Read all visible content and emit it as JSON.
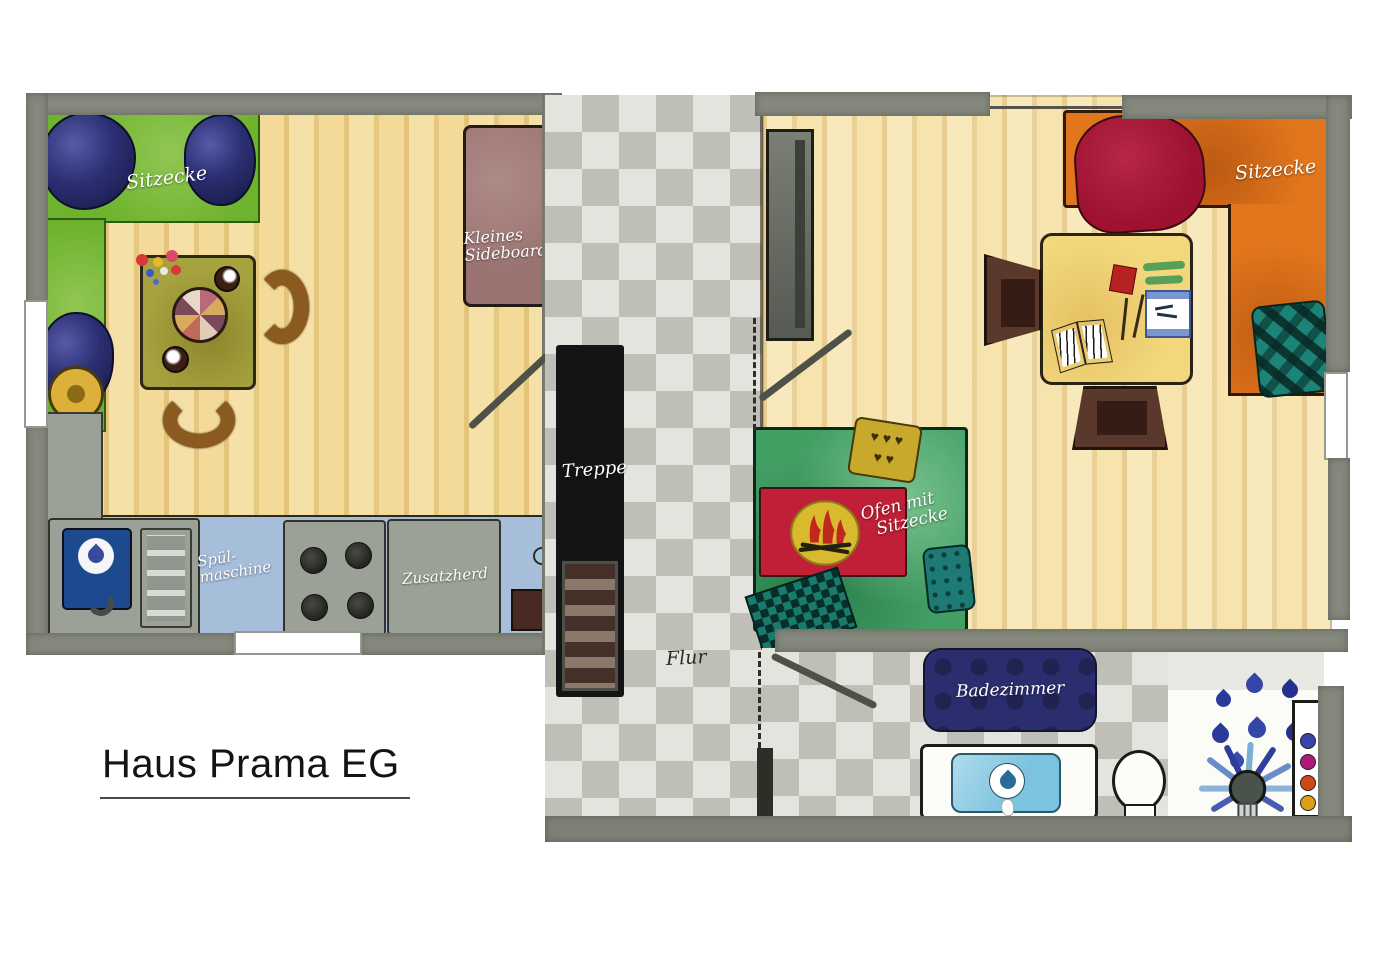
{
  "title": "Haus Prama EG",
  "plan": {
    "kitchen_dining": {
      "sitzecke_label": "Sitzecke",
      "sideboard_label_line1": "Kleines",
      "sideboard_label_line2": "Sideboard",
      "dishwasher_label_line1": "Spül-",
      "dishwasher_label_line2": "maschine",
      "stove_label": "Zusatzherd"
    },
    "corridor": {
      "stairs_label": "Treppe",
      "hall_label": "Flur"
    },
    "living": {
      "sitzecke_label": "Sitzecke",
      "oven_label_line1": "Ofen mit",
      "oven_label_line2": "Sitzecke",
      "heart_cushion_row1": "♥ ♥ ♥",
      "heart_cushion_row2": "♥ ♥"
    },
    "bathroom": {
      "label": "Badezimmer"
    }
  },
  "palette": {
    "wall_gray": "#85887d",
    "wood_floor": "#f1d793",
    "tile_light": "#e4e4df",
    "tile_dark": "#bfbfb7",
    "bench_green": "#6db32d",
    "cushion_navy": "#2b2f72",
    "table_olive": "#a6a23f",
    "chair_brown": "#8a5a1e",
    "sideboard_mauve": "#9a7370",
    "counter_blue": "#a7bedb",
    "appliance_gray": "#9ba197",
    "sink_navy": "#1d4a8f",
    "stairs_black": "#141414",
    "sofa_orange": "#e1761c",
    "blanket_red": "#9e1130",
    "teal": "#177a70",
    "rug_green": "#43a065",
    "oven_red": "#c11f37",
    "fire_yellow": "#d9ba2e",
    "desk_yellow": "#f2d77c",
    "bathmat_navy": "#2b2e6e",
    "basin_blue": "#7cc3e0"
  }
}
